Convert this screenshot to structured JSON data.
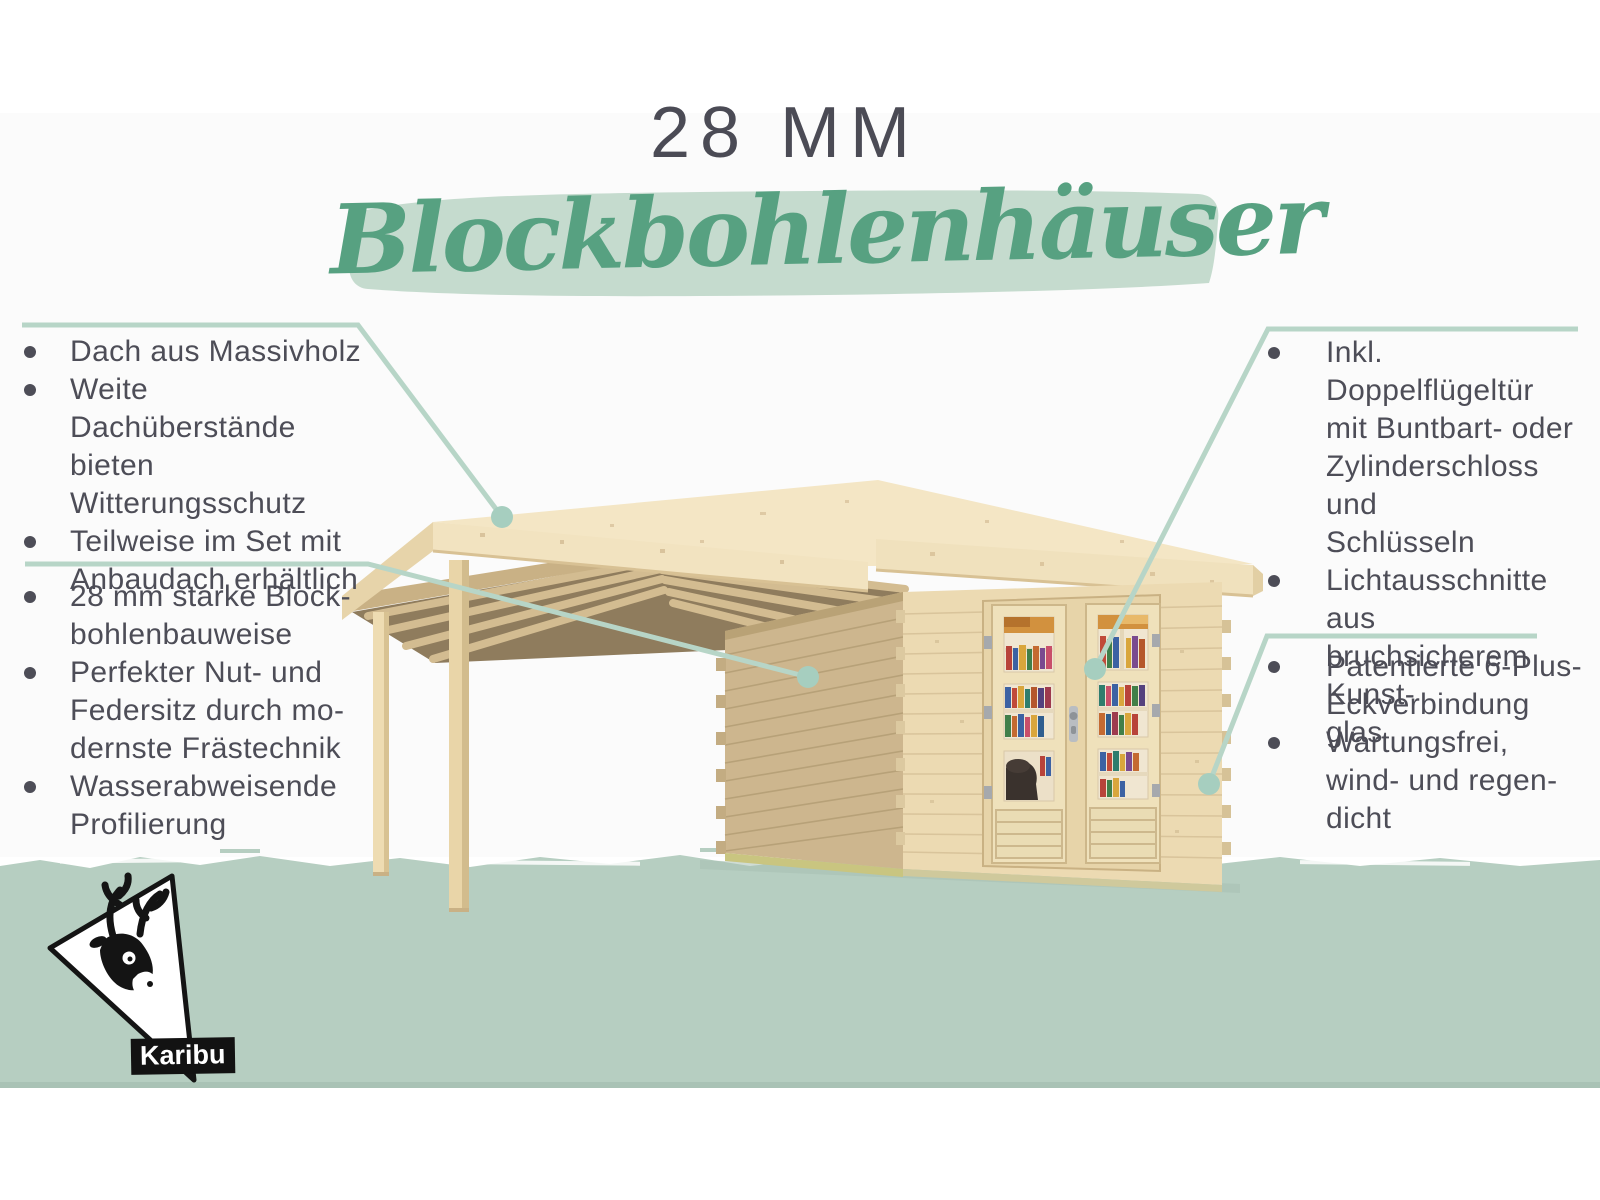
{
  "title": {
    "size_label": "28 MM",
    "product_line": "Blockbohlenhäuser"
  },
  "brand": {
    "name": "Karibu"
  },
  "callouts": {
    "top_left": {
      "items": [
        {
          "text": "Dach aus Massivholz"
        },
        {
          "text": "Weite Dachüberstände\nbieten Witterungsschutz"
        },
        {
          "text": "Teilweise im Set mit\nAnbaudach erhältlich"
        }
      ]
    },
    "bottom_left": {
      "items": [
        {
          "text": "28 mm starke Block-\nbohlenbauweise"
        },
        {
          "text": "Perfekter Nut- und\nFedersitz durch mo-\ndernste Frästechnik"
        },
        {
          "text": "Wasserabweisende\nProfilierung"
        }
      ]
    },
    "top_right": {
      "items": [
        {
          "text": "Inkl. Doppelflügeltür\nmit Buntbart- oder\nZylinderschloss und\nSchlüsseln"
        },
        {
          "text": "Lichtausschnitte aus\nbruchsicherem Kunst-\nglas"
        }
      ]
    },
    "bottom_right": {
      "items": [
        {
          "text": "Patentierte 6-Plus-\nEckverbindung"
        },
        {
          "text": "Wartungsfrei,\nwind- und regen-\ndicht"
        }
      ]
    }
  },
  "colors": {
    "text_dark": "#4d4d57",
    "script_green": "#57a181",
    "banner_green": "#c5dbce",
    "ground_green": "#b6cec1",
    "callout_line": "#b7d5c7",
    "callout_dot": "#a6cebf",
    "wood_light": "#f3e4c3",
    "wood_shadow_wall": "#cdb68e",
    "wood_front_wall": "#ecdab2"
  }
}
